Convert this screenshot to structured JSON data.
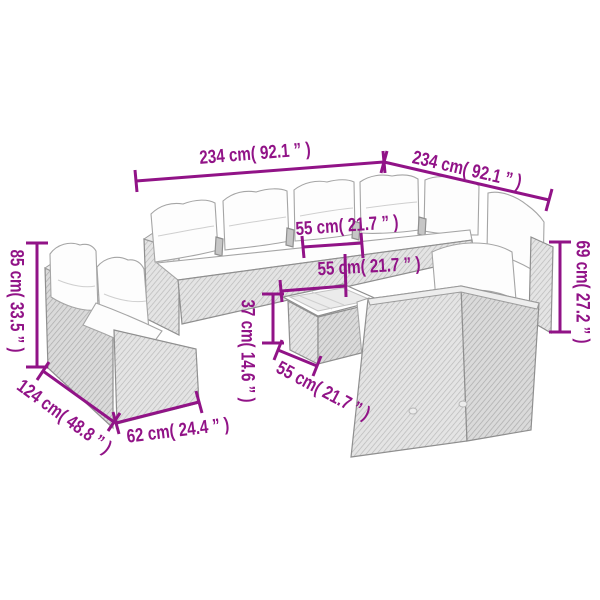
{
  "style": {
    "dimension_color": "#911387",
    "background_color": "#ffffff",
    "drawing_outline_color": "#8f8f8f"
  },
  "figure": {
    "kind": "product-dimension-line-drawing",
    "subject": "poly-rattan garden lounge sofa set with cushions, corner sofa, chair and coffee table"
  },
  "dimensions": {
    "back_width": {
      "label": "234 cm( 92.1 ” )"
    },
    "right_width": {
      "label": "234 cm( 92.1 ” )"
    },
    "left_height": {
      "label": "85 cm( 33.5 ” )"
    },
    "right_height": {
      "label": "69 cm( 27.2 ” )"
    },
    "left_depth": {
      "label": "124 cm( 48.8 ” )"
    },
    "front_width": {
      "label": "62 cm( 24.4 ” )"
    },
    "seat_width_a": {
      "label": "55 cm( 21.7 ” )"
    },
    "seat_width_b": {
      "label": "55 cm( 21.7 ” )"
    },
    "table_height": {
      "label": "37 cm( 14.6 ” )"
    },
    "seat_depth": {
      "label": "55 cm( 21.7 ” )"
    }
  }
}
